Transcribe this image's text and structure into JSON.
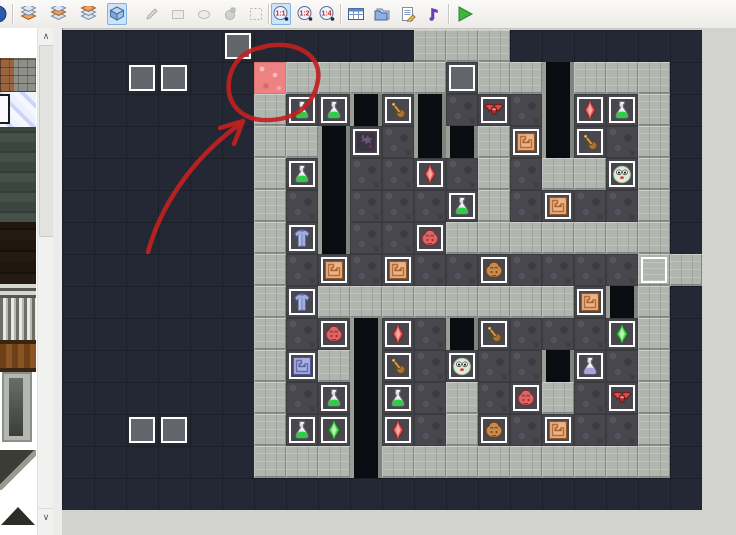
{
  "toolbar": {
    "zoom_labels": [
      "1:1",
      "1:2",
      "1:4"
    ],
    "items": [
      {
        "name": "app-icon-partial",
        "icon": "bluecircle",
        "x": -6,
        "interactable": false
      },
      {
        "name": "toolbar-separator-1",
        "icon": "sep",
        "x": 12
      },
      {
        "name": "layer1-button",
        "icon": "layers1",
        "x": 18
      },
      {
        "name": "layer2-button",
        "icon": "layers2",
        "x": 48
      },
      {
        "name": "layer3-button",
        "icon": "layers3",
        "x": 78
      },
      {
        "name": "event-layer-button",
        "icon": "cube",
        "x": 107,
        "selected": true
      },
      {
        "name": "pencil-tool-button",
        "icon": "pencil",
        "x": 142,
        "disabled": true
      },
      {
        "name": "rectangle-tool-button",
        "icon": "rect",
        "x": 168,
        "disabled": true
      },
      {
        "name": "ellipse-tool-button",
        "icon": "ellipse",
        "x": 194,
        "disabled": true
      },
      {
        "name": "fill-tool-button",
        "icon": "fill",
        "x": 220,
        "disabled": true
      },
      {
        "name": "select-tool-button",
        "icon": "select",
        "x": 246,
        "disabled": true
      },
      {
        "name": "toolbar-separator-2",
        "icon": "sep",
        "x": 268
      },
      {
        "name": "zoom-1-1-button",
        "icon": "zoom0",
        "x": 271,
        "selected": true
      },
      {
        "name": "zoom-1-2-button",
        "icon": "zoom1",
        "x": 295
      },
      {
        "name": "zoom-1-4-button",
        "icon": "zoom2",
        "x": 317
      },
      {
        "name": "toolbar-separator-3",
        "icon": "sep",
        "x": 340
      },
      {
        "name": "database-button",
        "icon": "database",
        "x": 346
      },
      {
        "name": "materials-button",
        "icon": "folders",
        "x": 372
      },
      {
        "name": "script-editor-button",
        "icon": "script",
        "x": 398
      },
      {
        "name": "sound-test-button",
        "icon": "note",
        "x": 424
      },
      {
        "name": "toolbar-separator-4",
        "icon": "sep",
        "x": 448
      },
      {
        "name": "playtest-button",
        "icon": "play",
        "x": 455
      }
    ]
  },
  "sidebar": {
    "tiles": [
      {
        "name": "tileset-brick-stone",
        "cls": "sb-brick"
      },
      {
        "name": "tileset-ice-crystal",
        "cls": "sb-ice"
      },
      {
        "name": "tileset-moss-stone",
        "cls": "sb-moss"
      },
      {
        "name": "tileset-dark-wood",
        "cls": "sb-darkwood"
      },
      {
        "name": "tileset-grate",
        "cls": "sb-grate"
      },
      {
        "name": "tileset-bars",
        "cls": "sb-bars"
      },
      {
        "name": "tileset-fence",
        "cls": "sb-fence"
      },
      {
        "name": "tileset-well",
        "cls": "sb-well"
      },
      {
        "name": "tileset-ramp",
        "cls": "sb-ramp"
      },
      {
        "name": "tileset-pyramid",
        "cls": "sb-pyramid"
      }
    ],
    "scroll_up_glyph": "∧",
    "scroll_down_glyph": "∨"
  },
  "canvas": {
    "origin_x": 62,
    "origin_y": 30,
    "cell": 32,
    "cols": 20,
    "rows": 15,
    "palette": {
      "background": "#242834",
      "grid_line": "#1a1e27",
      "wall": "#b0b5ae",
      "floor": "#47474d",
      "void": "#0a0c11",
      "lava": "#ee8181",
      "event_border": "#ffffff",
      "event_gray": "#62666c"
    },
    "tilemap": [
      "...........WWW......",
      "......LWWWWWFWWVWWW.",
      "......WFFVFVFFFVFFW.",
      "......WWVFFVVWFVFFW.",
      "......WFVFFFFWFWWFW.",
      "......WFVFFFFWFFFFW.",
      "......WFVFFFWWWWWWW.",
      "......WFFFFFFFFFFFWW",
      "......WFWWWWWWWWFVW.",
      "......WFFVFFVFFFFFW.",
      "......WFWVFFFFFVFFW.",
      "......WFFVFFWFFWFFW.",
      "......WFFVFFWFFFFFW.",
      "......WWWVWWWWWWWWW.",
      "...................."
    ],
    "events": [
      {
        "col": 5,
        "row": 0,
        "icon": "gray-square"
      },
      {
        "col": 2,
        "row": 1,
        "icon": "gray-square"
      },
      {
        "col": 3,
        "row": 1,
        "icon": "gray-square"
      },
      {
        "col": 12,
        "row": 1,
        "icon": "gray-square"
      },
      {
        "col": 2,
        "row": 12,
        "icon": "gray-square"
      },
      {
        "col": 3,
        "row": 12,
        "icon": "gray-square"
      },
      {
        "col": 18,
        "row": 7,
        "icon": "wall-square"
      },
      {
        "col": 7,
        "row": 2,
        "icon": "green-potion"
      },
      {
        "col": 8,
        "row": 2,
        "icon": "green-potion"
      },
      {
        "col": 17,
        "row": 2,
        "icon": "green-potion"
      },
      {
        "col": 7,
        "row": 4,
        "icon": "green-potion"
      },
      {
        "col": 12,
        "row": 5,
        "icon": "green-potion"
      },
      {
        "col": 8,
        "row": 11,
        "icon": "green-potion"
      },
      {
        "col": 10,
        "row": 11,
        "icon": "green-potion"
      },
      {
        "col": 7,
        "row": 12,
        "icon": "green-potion"
      },
      {
        "col": 16,
        "row": 10,
        "icon": "purple-potion"
      },
      {
        "col": 10,
        "row": 2,
        "icon": "wood-club"
      },
      {
        "col": 16,
        "row": 3,
        "icon": "wood-club"
      },
      {
        "col": 13,
        "row": 9,
        "icon": "wood-club"
      },
      {
        "col": 10,
        "row": 10,
        "icon": "wood-club"
      },
      {
        "col": 13,
        "row": 2,
        "icon": "red-bat"
      },
      {
        "col": 17,
        "row": 11,
        "icon": "red-bat"
      },
      {
        "col": 16,
        "row": 2,
        "icon": "red-crystal"
      },
      {
        "col": 11,
        "row": 4,
        "icon": "red-crystal"
      },
      {
        "col": 10,
        "row": 9,
        "icon": "red-crystal"
      },
      {
        "col": 10,
        "row": 12,
        "icon": "red-crystal"
      },
      {
        "col": 17,
        "row": 9,
        "icon": "green-crystal"
      },
      {
        "col": 8,
        "row": 12,
        "icon": "green-crystal"
      },
      {
        "col": 9,
        "row": 3,
        "icon": "demon-tile"
      },
      {
        "col": 14,
        "row": 3,
        "icon": "orange-switch"
      },
      {
        "col": 15,
        "row": 5,
        "icon": "orange-switch"
      },
      {
        "col": 8,
        "row": 7,
        "icon": "orange-switch"
      },
      {
        "col": 10,
        "row": 7,
        "icon": "orange-switch"
      },
      {
        "col": 16,
        "row": 8,
        "icon": "orange-switch"
      },
      {
        "col": 15,
        "row": 12,
        "icon": "orange-switch"
      },
      {
        "col": 7,
        "row": 10,
        "icon": "purple-switch"
      },
      {
        "col": 17,
        "row": 4,
        "icon": "ghost"
      },
      {
        "col": 12,
        "row": 10,
        "icon": "ghost"
      },
      {
        "col": 7,
        "row": 6,
        "icon": "blue-armor"
      },
      {
        "col": 7,
        "row": 8,
        "icon": "blue-armor"
      },
      {
        "col": 11,
        "row": 6,
        "icon": "red-beast"
      },
      {
        "col": 8,
        "row": 9,
        "icon": "red-beast"
      },
      {
        "col": 14,
        "row": 11,
        "icon": "red-beast"
      },
      {
        "col": 13,
        "row": 7,
        "icon": "brown-beast"
      },
      {
        "col": 13,
        "row": 12,
        "icon": "brown-beast"
      },
      {
        "col": 6,
        "row": 1,
        "icon": "lava-tile"
      }
    ],
    "icons": {
      "green-potion": {
        "liquid": "#2ecc40",
        "flask": "#eef0f6",
        "dark": "#6a7086"
      },
      "purple-potion": {
        "liquid": "#b39ddb",
        "flask": "#eef0f6",
        "dark": "#6a7086"
      },
      "red-crystal": {
        "main": "#e25555",
        "light": "#f6b3b3",
        "dark": "#8a2020"
      },
      "green-crystal": {
        "main": "#4ade4a",
        "light": "#c4f4c4",
        "dark": "#1f7a1f"
      },
      "wood-club": {
        "main": "#d2a159",
        "light": "#e8c890",
        "dark": "#6b4612",
        "knob": "#a8742f"
      },
      "red-bat": {
        "main": "#d84a4a",
        "body": "#b03030",
        "dark": "#701515"
      },
      "ghost": {
        "main": "#dcead6",
        "dark": "#a6bca0"
      },
      "blue-armor": {
        "main": "#a3aed8",
        "light": "#c8d0ec",
        "dark": "#5560a0"
      },
      "orange-switch": {
        "main": "#edb288",
        "dark": "#96561f"
      },
      "purple-switch": {
        "main": "#aab0dc",
        "dark": "#4a55a0"
      },
      "demon-tile": {
        "main": "#3a3342",
        "dark": "#6e5e80",
        "spark": "#d86a9a"
      },
      "red-beast": {
        "main": "#d96666",
        "dark": "#8a2525"
      },
      "brown-beast": {
        "main": "#c98a4e",
        "dark": "#6e4015"
      },
      "gray-square": {
        "main": "#62666c"
      },
      "wall-square": {
        "main": "#b0b5ae"
      }
    },
    "annotation": {
      "color": "#c21f1f",
      "stroke_width": 4.5,
      "circle_path": "M200,17 C232,9 260,24 256,50 C252,76 232,90 206,90 C180,91 164,74 167,51 C170,32 182,20 202,17",
      "arrow_shaft_path": "M86,222 C98,178 128,130 178,94",
      "arrow_head_path": "M158,98 L181,91 L172,114"
    }
  }
}
